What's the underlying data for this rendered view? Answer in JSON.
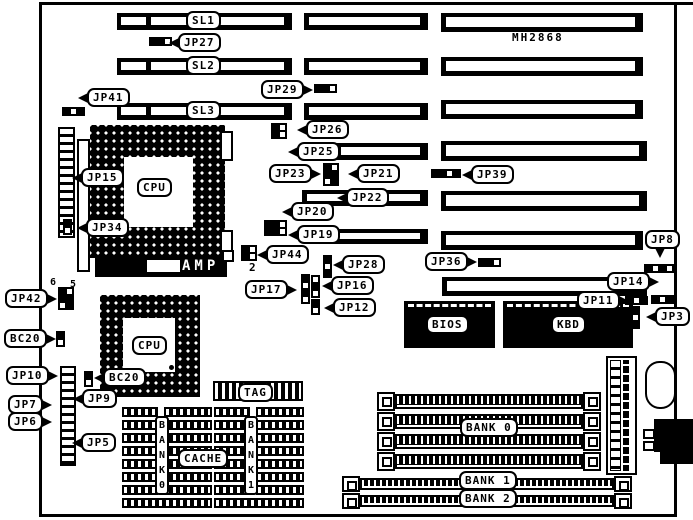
{
  "diagram": {
    "board_model": "MH2868",
    "chips": {
      "amp": "AMP"
    },
    "callouts": [
      {
        "name": "slot-sl1",
        "text": "SL1",
        "x": 186,
        "y": 11,
        "tail": "none"
      },
      {
        "name": "slot-sl2",
        "text": "SL2",
        "x": 186,
        "y": 56,
        "tail": "none"
      },
      {
        "name": "slot-sl3",
        "text": "SL3",
        "x": 186,
        "y": 101,
        "tail": "none"
      },
      {
        "name": "jp27",
        "text": "JP27",
        "x": 178,
        "y": 33,
        "tail": "l"
      },
      {
        "name": "jp29",
        "text": "JP29",
        "x": 261,
        "y": 80,
        "tail": "r"
      },
      {
        "name": "jp41",
        "text": "JP41",
        "x": 87,
        "y": 88,
        "tail": "l"
      },
      {
        "name": "jp26",
        "text": "JP26",
        "x": 306,
        "y": 120,
        "tail": "l"
      },
      {
        "name": "jp25",
        "text": "JP25",
        "x": 297,
        "y": 142,
        "tail": "l"
      },
      {
        "name": "jp23",
        "text": "JP23",
        "x": 269,
        "y": 164,
        "tail": "r"
      },
      {
        "name": "jp21",
        "text": "JP21",
        "x": 357,
        "y": 164,
        "tail": "l"
      },
      {
        "name": "jp39",
        "text": "JP39",
        "x": 471,
        "y": 165,
        "tail": "l"
      },
      {
        "name": "jp22",
        "text": "JP22",
        "x": 346,
        "y": 188,
        "tail": "l"
      },
      {
        "name": "jp20",
        "text": "JP20",
        "x": 291,
        "y": 202,
        "tail": "l"
      },
      {
        "name": "jp19",
        "text": "JP19",
        "x": 297,
        "y": 225,
        "tail": "l"
      },
      {
        "name": "jp8",
        "text": "JP8",
        "x": 645,
        "y": 230,
        "tail": "d"
      },
      {
        "name": "jp44",
        "text": "JP44",
        "x": 266,
        "y": 245,
        "tail": "l"
      },
      {
        "name": "jp36",
        "text": "JP36",
        "x": 425,
        "y": 252,
        "tail": "r"
      },
      {
        "name": "jp28",
        "text": "JP28",
        "x": 342,
        "y": 255,
        "tail": "l"
      },
      {
        "name": "jp14",
        "text": "JP14",
        "x": 607,
        "y": 272,
        "tail": "r"
      },
      {
        "name": "jp17",
        "text": "JP17",
        "x": 245,
        "y": 280,
        "tail": "r"
      },
      {
        "name": "jp16",
        "text": "JP16",
        "x": 331,
        "y": 276,
        "tail": "l"
      },
      {
        "name": "jp11",
        "text": "JP11",
        "x": 577,
        "y": 291,
        "tail": "r"
      },
      {
        "name": "jp12",
        "text": "JP12",
        "x": 333,
        "y": 298,
        "tail": "l"
      },
      {
        "name": "jp3",
        "text": "JP3",
        "x": 655,
        "y": 307,
        "tail": "l"
      },
      {
        "name": "jp42",
        "text": "JP42",
        "x": 5,
        "y": 289,
        "tail": "r"
      },
      {
        "name": "bc20-left",
        "text": "BC20",
        "x": 4,
        "y": 329,
        "tail": "r"
      },
      {
        "name": "jp15",
        "text": "JP15",
        "x": 81,
        "y": 168,
        "tail": "l"
      },
      {
        "name": "jp34",
        "text": "JP34",
        "x": 86,
        "y": 218,
        "tail": "l"
      },
      {
        "name": "jp10",
        "text": "JP10",
        "x": 6,
        "y": 366,
        "tail": "r"
      },
      {
        "name": "bc20-cpu",
        "text": "BC20",
        "x": 103,
        "y": 368,
        "tail": "l"
      },
      {
        "name": "jp9",
        "text": "JP9",
        "x": 82,
        "y": 389,
        "tail": "l"
      },
      {
        "name": "jp7",
        "text": "JP7",
        "x": 8,
        "y": 395,
        "tail": "r"
      },
      {
        "name": "jp6",
        "text": "JP6",
        "x": 8,
        "y": 412,
        "tail": "r"
      },
      {
        "name": "jp5",
        "text": "JP5",
        "x": 81,
        "y": 433,
        "tail": "l"
      },
      {
        "name": "cpu1-label",
        "text": "CPU",
        "x": 137,
        "y": 178,
        "tail": "none"
      },
      {
        "name": "cpu2-label",
        "text": "CPU",
        "x": 132,
        "y": 336,
        "tail": "none"
      },
      {
        "name": "bios-label",
        "text": "BIOS",
        "x": 426,
        "y": 315,
        "tail": "none"
      },
      {
        "name": "kbd-label",
        "text": "KBD",
        "x": 551,
        "y": 315,
        "tail": "none"
      },
      {
        "name": "tag-label",
        "text": "TAG",
        "x": 238,
        "y": 383,
        "tail": "none"
      },
      {
        "name": "cache-label",
        "text": "CACHE",
        "x": 178,
        "y": 449,
        "tail": "none"
      },
      {
        "name": "bank0-label",
        "text": "BANK 0",
        "x": 460,
        "y": 418,
        "tail": "none"
      },
      {
        "name": "bank1-label",
        "text": "BANK 1",
        "x": 459,
        "y": 471,
        "tail": "none"
      },
      {
        "name": "bank2-label",
        "text": "BANK 2",
        "x": 459,
        "y": 489,
        "tail": "none"
      }
    ],
    "free_texts": [
      {
        "name": "pin-number-2",
        "text": "2",
        "x": 249,
        "y": 261,
        "size": 11
      },
      {
        "name": "pin-number-6",
        "text": "6",
        "x": 50,
        "y": 277,
        "size": 10
      },
      {
        "name": "pin-number-5",
        "text": "5",
        "x": 70,
        "y": 279,
        "size": 10
      }
    ],
    "vlabels": [
      {
        "name": "cache-bank0-label",
        "text": "B\nA\nN\nK\n0",
        "x": 155,
        "y": 416
      },
      {
        "name": "cache-bank1-label",
        "text": "B\nA\nN\nK\n1",
        "x": 244,
        "y": 416
      }
    ],
    "slots": {
      "bars": [
        {
          "x": 117,
          "y": 13,
          "w": 175,
          "h": 17,
          "kind": "sl"
        },
        {
          "x": 117,
          "y": 58,
          "w": 175,
          "h": 17,
          "kind": "sl"
        },
        {
          "x": 117,
          "y": 103,
          "w": 175,
          "h": 17,
          "kind": "sl"
        },
        {
          "x": 304,
          "y": 13,
          "w": 124,
          "h": 17,
          "kind": "p"
        },
        {
          "x": 304,
          "y": 58,
          "w": 124,
          "h": 17,
          "kind": "p"
        },
        {
          "x": 304,
          "y": 103,
          "w": 124,
          "h": 17,
          "kind": "p"
        },
        {
          "x": 336,
          "y": 143,
          "w": 92,
          "h": 17,
          "kind": "p"
        },
        {
          "x": 302,
          "y": 190,
          "w": 126,
          "h": 16,
          "kind": "p"
        },
        {
          "x": 309,
          "y": 229,
          "w": 119,
          "h": 15,
          "kind": "p"
        },
        {
          "x": 441,
          "y": 13,
          "w": 202,
          "h": 19,
          "kind": "p"
        },
        {
          "x": 441,
          "y": 57,
          "w": 202,
          "h": 19,
          "kind": "p"
        },
        {
          "x": 441,
          "y": 100,
          "w": 202,
          "h": 19,
          "kind": "p"
        },
        {
          "x": 441,
          "y": 141,
          "w": 206,
          "h": 20,
          "kind": "p"
        },
        {
          "x": 441,
          "y": 191,
          "w": 206,
          "h": 20,
          "kind": "p"
        },
        {
          "x": 441,
          "y": 231,
          "w": 202,
          "h": 19,
          "kind": "p"
        },
        {
          "x": 442,
          "y": 277,
          "w": 205,
          "h": 19,
          "kind": "p"
        }
      ]
    },
    "jumpers": [
      {
        "name": "jp27-pins",
        "x": 149,
        "y": 37,
        "cols": 3,
        "rows": 1,
        "p": "110"
      },
      {
        "name": "jp29-pins",
        "x": 314,
        "y": 84,
        "cols": 3,
        "rows": 1,
        "p": "110"
      },
      {
        "name": "jp41-pins",
        "x": 62,
        "y": 107,
        "cols": 3,
        "rows": 1,
        "p": "101"
      },
      {
        "name": "jp26-pins",
        "x": 271,
        "y": 123,
        "cols": 2,
        "rows": 2,
        "p": "1010"
      },
      {
        "name": "jp23-jp21-pins",
        "x": 323,
        "y": 163,
        "cols": 2,
        "rows": 3,
        "p": "101101"
      },
      {
        "name": "jp39-pins",
        "x": 431,
        "y": 169,
        "cols": 4,
        "rows": 1,
        "p": "1101"
      },
      {
        "name": "jp20-jp19-pins",
        "x": 264,
        "y": 220,
        "cols": 3,
        "rows": 2,
        "p": "110110"
      },
      {
        "name": "jp44-pins",
        "x": 241,
        "y": 245,
        "cols": 2,
        "rows": 2,
        "p": "1010"
      },
      {
        "name": "jp28-pins",
        "x": 323,
        "y": 255,
        "cols": 1,
        "rows": 3,
        "p": "101"
      },
      {
        "name": "jp17-pins",
        "x": 301,
        "y": 274,
        "cols": 1,
        "rows": 4,
        "p": "1010"
      },
      {
        "name": "jp16-pins",
        "x": 311,
        "y": 275,
        "cols": 1,
        "rows": 3,
        "p": "010"
      },
      {
        "name": "jp12-pins",
        "x": 311,
        "y": 299,
        "cols": 1,
        "rows": 2,
        "p": "10"
      },
      {
        "name": "jp36-pins",
        "x": 478,
        "y": 258,
        "cols": 3,
        "rows": 1,
        "p": "110"
      },
      {
        "name": "jp8-pins",
        "x": 644,
        "y": 264,
        "cols": 4,
        "rows": 1,
        "p": "1010"
      },
      {
        "name": "jp14-pins",
        "x": 651,
        "y": 295,
        "cols": 3,
        "rows": 1,
        "p": "101"
      },
      {
        "name": "jp11-pins",
        "x": 625,
        "y": 296,
        "cols": 3,
        "rows": 1,
        "p": "101"
      },
      {
        "name": "jp3-pins",
        "x": 631,
        "y": 306,
        "cols": 1,
        "rows": 3,
        "p": "101"
      },
      {
        "name": "jp42-pins",
        "x": 58,
        "y": 287,
        "cols": 2,
        "rows": 3,
        "p": "101101"
      },
      {
        "name": "bc20-left-pins",
        "x": 56,
        "y": 331,
        "cols": 1,
        "rows": 2,
        "p": "10"
      },
      {
        "name": "jp34-pins",
        "x": 63,
        "y": 219,
        "cols": 1,
        "rows": 2,
        "p": "10"
      },
      {
        "name": "bc20-cpu-pins",
        "x": 84,
        "y": 371,
        "cols": 1,
        "rows": 2,
        "p": "10"
      }
    ],
    "cache_banks": {
      "cols": [
        {
          "x": 122
        },
        {
          "x": 214
        }
      ],
      "rows": 7,
      "top": 407,
      "row_h": 13,
      "col_w": 90
    },
    "simms": [
      {
        "name": "bank0-socket-1",
        "x": 377,
        "y": 392,
        "w": 224,
        "h": 19
      },
      {
        "name": "bank0-socket-2",
        "x": 377,
        "y": 412,
        "w": 224,
        "h": 19
      },
      {
        "name": "bank0-socket-3",
        "x": 377,
        "y": 432,
        "w": 224,
        "h": 19
      },
      {
        "name": "bank0-socket-4",
        "x": 377,
        "y": 452,
        "w": 224,
        "h": 19
      },
      {
        "name": "bank1-socket",
        "x": 342,
        "y": 476,
        "w": 290,
        "h": 16
      },
      {
        "name": "bank2-socket",
        "x": 342,
        "y": 493,
        "w": 290,
        "h": 16
      }
    ],
    "colors": {
      "ink": "#000000",
      "paper": "#ffffff"
    }
  }
}
